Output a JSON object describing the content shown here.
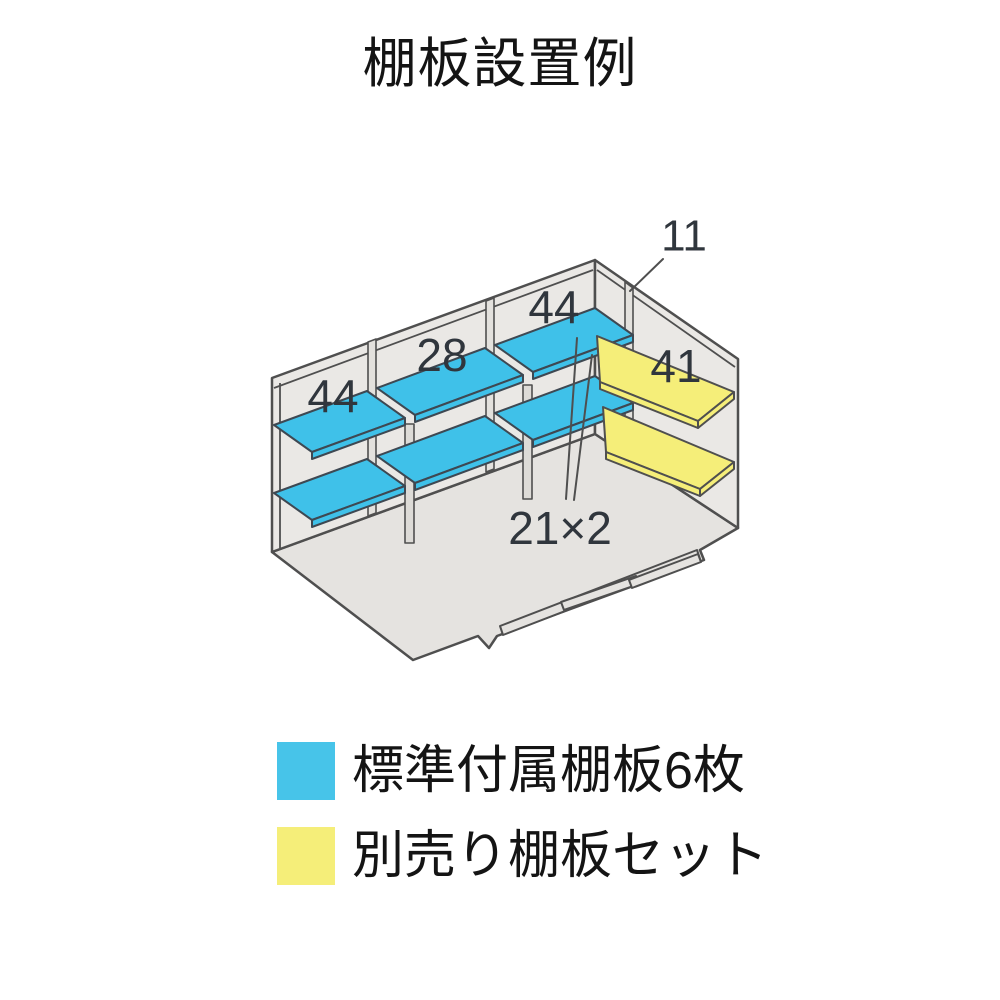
{
  "title": "棚板設置例",
  "diagram": {
    "shelf_labels": {
      "left_shelf_width": "44",
      "middle_shelf_width": "28",
      "right_shelf_width": "44",
      "optional_shelf_width": "41",
      "support_count": "21×2",
      "side_panel_count": "11"
    },
    "colors": {
      "standard_shelf_blue": "#47C4E9",
      "optional_shelf_yellow": "#F5EE79",
      "wall_gray": "#EAE8E5",
      "floor_gray": "#E5E3E0",
      "outline": "#4F4F4F"
    }
  },
  "legend": {
    "items": [
      {
        "swatch_color": "#47C4E9",
        "label": "標準付属棚板6枚"
      },
      {
        "swatch_color": "#F5EE79",
        "label": "別売り棚板セット"
      }
    ]
  }
}
